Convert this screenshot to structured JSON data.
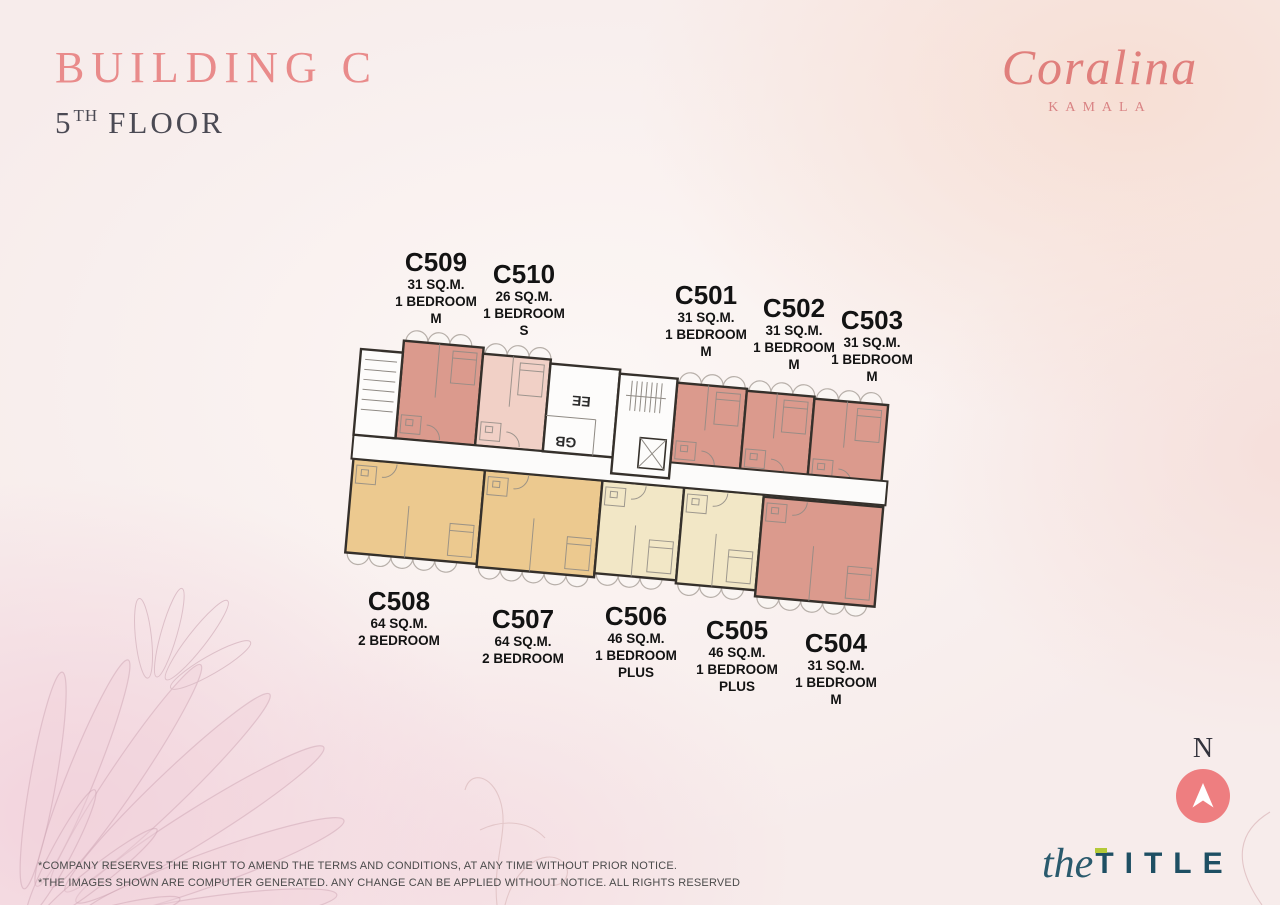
{
  "header": {
    "building": "BUILDING C",
    "floor_number": "5",
    "floor_suffix": "TH",
    "floor_word": "FLOOR"
  },
  "brand": {
    "name": "Coralina",
    "location": "KAMALA"
  },
  "compass": {
    "label": "N"
  },
  "footer_logo": {
    "script": "the",
    "caps": "TITLE"
  },
  "disclaimer": {
    "line1": "*COMPANY RESERVES THE RIGHT TO AMEND THE TERMS AND CONDITIONS, AT ANY TIME WITHOUT PRIOR NOTICE.",
    "line2": "*THE IMAGES SHOWN ARE COMPUTER GENERATED. ANY CHANGE CAN BE APPLIED WITHOUT NOTICE. ALL RIGHTS RESERVED"
  },
  "colors": {
    "title_pink": "#E98B8B",
    "dark_text": "#4B4A54",
    "brand_coral": "#E07F7C",
    "compass_circle": "#EE7E80",
    "logo_teal": "#1E4F63",
    "logo_lime": "#B3C938",
    "wall": "#35302B",
    "corridor_fill": "#FCFBFA",
    "unit_salmon": "#DB9A8D",
    "unit_light_pink": "#F1D0C6",
    "unit_tan": "#ECC98F",
    "unit_cream": "#F2E7C6"
  },
  "floorplan": {
    "core_labels": {
      "stair": "EE",
      "lobby": "GB"
    },
    "corridor": {
      "x": 352,
      "y": 464,
      "w": 536,
      "h": 24
    },
    "core_blocks": [
      {
        "name": "stair-left",
        "x": 352,
        "y": 378,
        "w": 42,
        "h": 86,
        "kind": "stairs-h"
      },
      {
        "name": "ee-gb-rooms",
        "x": 542,
        "y": 376,
        "w": 70,
        "h": 88,
        "kind": "rooms"
      },
      {
        "name": "central-core",
        "x": 612,
        "y": 380,
        "w": 58,
        "h": 100,
        "kind": "stairs-lift"
      }
    ],
    "units": [
      {
        "id": "C509",
        "area": "31 SQ.M.",
        "type_lines": [
          "1 BEDROOM",
          "M"
        ],
        "fill": "#DB9A8D",
        "row": "top",
        "balcony": "top",
        "rect": {
          "x": 394,
          "y": 366,
          "w": 80,
          "h": 98
        },
        "label": {
          "x": 436,
          "y": 248
        }
      },
      {
        "id": "C510",
        "area": "26 SQ.M.",
        "type_lines": [
          "1 BEDROOM",
          "S"
        ],
        "fill": "#F1D0C6",
        "row": "top",
        "balcony": "top",
        "rect": {
          "x": 474,
          "y": 372,
          "w": 68,
          "h": 92
        },
        "label": {
          "x": 524,
          "y": 260
        }
      },
      {
        "id": "C501",
        "area": "31 SQ.M.",
        "type_lines": [
          "1 BEDROOM",
          "M"
        ],
        "fill": "#DB9A8D",
        "row": "top",
        "balcony": "top",
        "rect": {
          "x": 670,
          "y": 384,
          "w": 70,
          "h": 82
        },
        "label": {
          "x": 706,
          "y": 281
        }
      },
      {
        "id": "C502",
        "area": "31 SQ.M.",
        "type_lines": [
          "1 BEDROOM",
          "M"
        ],
        "fill": "#DB9A8D",
        "row": "top",
        "balcony": "top",
        "rect": {
          "x": 740,
          "y": 386,
          "w": 68,
          "h": 82
        },
        "label": {
          "x": 794,
          "y": 294
        }
      },
      {
        "id": "C503",
        "area": "31 SQ.M.",
        "type_lines": [
          "1 BEDROOM",
          "M"
        ],
        "fill": "#DB9A8D",
        "row": "top",
        "balcony": "top",
        "rect": {
          "x": 808,
          "y": 388,
          "w": 74,
          "h": 84
        },
        "label": {
          "x": 872,
          "y": 306
        }
      },
      {
        "id": "C508",
        "area": "64 SQ.M.",
        "type_lines": [
          "2 BEDROOM"
        ],
        "fill": "#ECC98F",
        "row": "bottom",
        "balcony": "bottom",
        "rect": {
          "x": 354,
          "y": 488,
          "w": 132,
          "h": 94
        },
        "label": {
          "x": 399,
          "y": 587
        }
      },
      {
        "id": "C507",
        "area": "64 SQ.M.",
        "type_lines": [
          "2 BEDROOM"
        ],
        "fill": "#ECC98F",
        "row": "bottom",
        "balcony": "bottom",
        "rect": {
          "x": 486,
          "y": 488,
          "w": 118,
          "h": 97
        },
        "label": {
          "x": 523,
          "y": 605
        }
      },
      {
        "id": "C506",
        "area": "46 SQ.M.",
        "type_lines": [
          "1 BEDROOM",
          "PLUS"
        ],
        "fill": "#F2E7C6",
        "row": "bottom",
        "balcony": "bottom",
        "rect": {
          "x": 604,
          "y": 488,
          "w": 82,
          "h": 93
        },
        "label": {
          "x": 636,
          "y": 602
        }
      },
      {
        "id": "C505",
        "area": "46 SQ.M.",
        "type_lines": [
          "1 BEDROOM",
          "PLUS"
        ],
        "fill": "#F2E7C6",
        "row": "bottom",
        "balcony": "bottom",
        "rect": {
          "x": 686,
          "y": 488,
          "w": 80,
          "h": 96
        },
        "label": {
          "x": 737,
          "y": 616
        }
      },
      {
        "id": "C504",
        "area": "31 SQ.M.",
        "type_lines": [
          "1 BEDROOM",
          "M"
        ],
        "fill": "#DB9A8D",
        "row": "bottom",
        "balcony": "bottom",
        "rect": {
          "x": 766,
          "y": 490,
          "w": 120,
          "h": 100
        },
        "label": {
          "x": 836,
          "y": 629
        }
      }
    ]
  }
}
